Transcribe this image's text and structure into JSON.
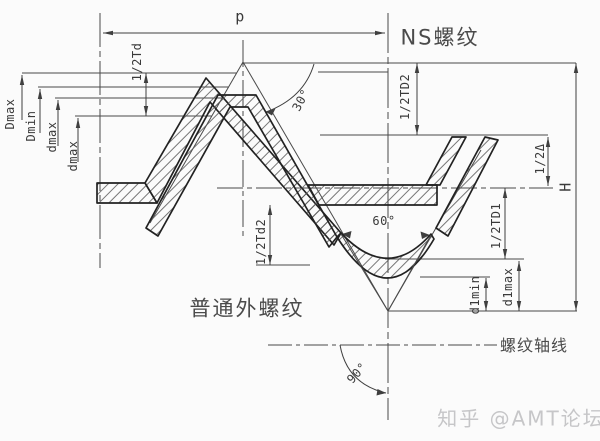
{
  "drawing": {
    "type": "thread-profile-engineering-drawing",
    "labels": {
      "pitch": "p",
      "ns_thread": "NS螺纹",
      "ordinary_external_thread": "普通外螺纹",
      "thread_axis": "螺纹轴线",
      "half_Td": "1/2Td",
      "half_TD2": "1/2TD2",
      "half_Td2": "1/2Td2",
      "half_TD1": "1/2TD1",
      "half_delta": "1/2Δ",
      "height_H": "H",
      "D_max": "Dmax",
      "D_min": "Dmin",
      "d_max_upper": "dmax",
      "d_max_lower": "dmax",
      "d1_min": "d1min",
      "d1_max": "d1max",
      "angle_30": "30°",
      "angle_60": "60°",
      "angle_90": "90°"
    },
    "watermark": "知乎 @AMT论坛",
    "colors": {
      "background": "#fbfbfb",
      "construction_line": "#4a4a4a",
      "profile_line": "#222222",
      "text": "#3a3a3a",
      "watermark": "#c6c6c8"
    }
  }
}
